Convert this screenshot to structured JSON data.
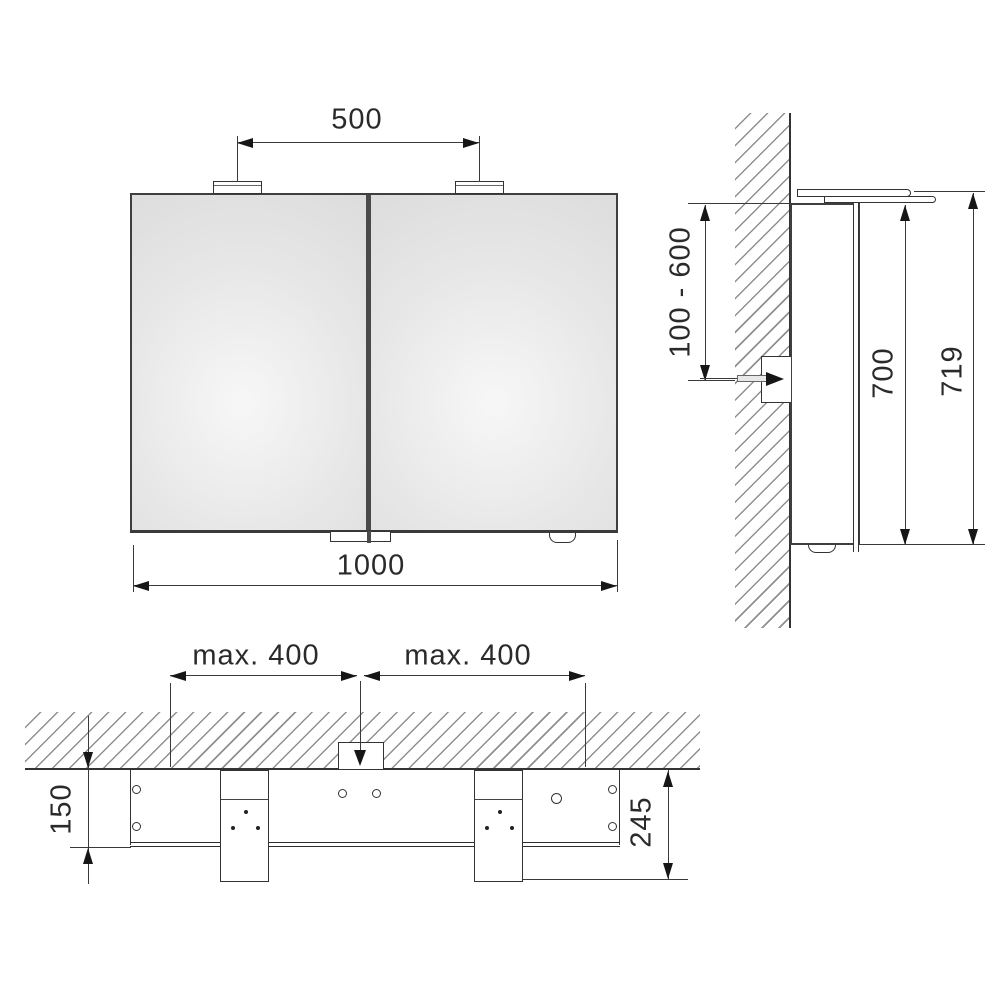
{
  "drawing": {
    "front_view": {
      "dim_light_spacing": "500",
      "dim_width": "1000"
    },
    "side_view": {
      "dim_outlet_height_range": "100 - 600",
      "dim_cabinet_height": "700",
      "dim_total_height": "719"
    },
    "top_view": {
      "dim_outlet_offset_left": "max. 400",
      "dim_outlet_offset_right": "max. 400",
      "dim_cabinet_depth": "150",
      "dim_total_depth": "245"
    },
    "colors": {
      "line": "#333333",
      "hatch": "#8f8f8f",
      "mirror_light": "#f6f6f6",
      "mirror_dark": "#d7d7d7",
      "background": "#ffffff"
    }
  }
}
